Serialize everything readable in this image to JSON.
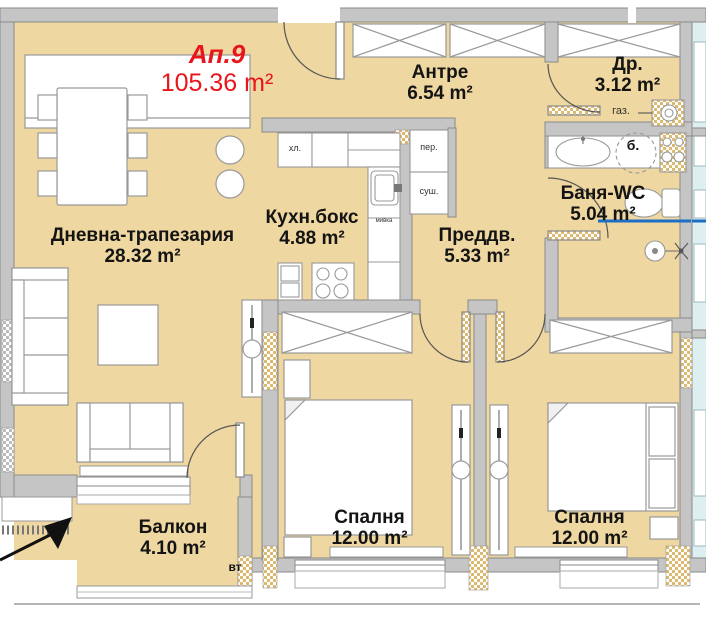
{
  "apartment": {
    "id": "Ап.9",
    "area": "105.36 m²"
  },
  "rooms": {
    "living": {
      "name": "Дневна-трапезария",
      "area": "28.32 m²"
    },
    "kitchen": {
      "name": "Кухн.бокс",
      "area": "4.88 m²"
    },
    "antre": {
      "name": "Антре",
      "area": "6.54 m²"
    },
    "dressing": {
      "name": "Др.",
      "area": "3.12 m²"
    },
    "bath": {
      "name": "Баня-WC",
      "area": "5.04 m²"
    },
    "vestibule": {
      "name": "Преддв.",
      "area": "5.33 m²"
    },
    "balcony": {
      "name": "Балкон",
      "area": "4.10 m²"
    },
    "bedroom1": {
      "name": "Спалня",
      "area": "12.00 m²"
    },
    "bedroom2": {
      "name": "Спалня",
      "area": "12.00 m²"
    }
  },
  "fixtures": {
    "fridge": "хл.",
    "washer": "пер.",
    "dryer": "суш.",
    "sink": "мивка",
    "gas": "газ.",
    "boiler": "б.",
    "vent": "вт"
  },
  "colors": {
    "floor": "#eed7a0",
    "wall": "#c5c5c5",
    "wall_edge": "#8a8a8a",
    "accent_red": "#e8151b",
    "neighbor_floor": "#ddeff0",
    "shower_line": "#1c6fc4"
  }
}
